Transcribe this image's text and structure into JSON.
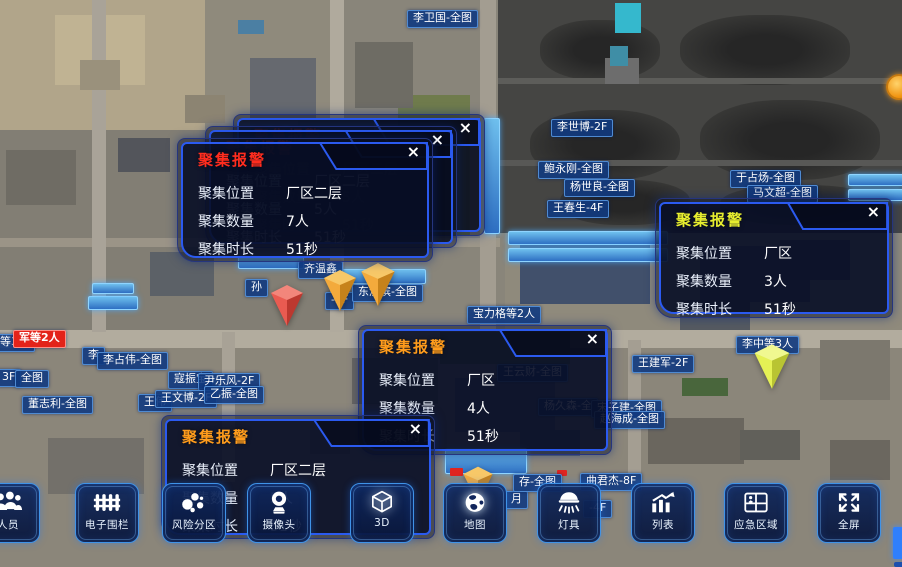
{
  "ui": {
    "close_glyph": "×"
  },
  "alarm_panels": [
    {
      "variant": "ghost",
      "x": 233,
      "y": 114,
      "w": 250,
      "h": 120,
      "title": "聚集报警",
      "title_color": "#8a1812",
      "fields": [
        {
          "label": "聚集位置",
          "value": "厂区二层"
        },
        {
          "label": "聚集数量",
          "value": "5人"
        },
        {
          "label": "聚集时长",
          "value": "51秒"
        }
      ]
    },
    {
      "variant": "ghost",
      "x": 205,
      "y": 126,
      "w": 250,
      "h": 120,
      "title": "聚集报警",
      "title_color": "#8a1812",
      "fields": [
        {
          "label": "聚集位置",
          "value": "厂区二层"
        },
        {
          "label": "聚集数量",
          "value": "5人"
        },
        {
          "label": "聚集时长",
          "value": "51秒"
        }
      ]
    },
    {
      "variant": "front",
      "x": 177,
      "y": 138,
      "w": 254,
      "h": 122,
      "title": "聚集报警",
      "title_color": "#ff2d1f",
      "fields": [
        {
          "label": "聚集位置",
          "value": "厂区二层"
        },
        {
          "label": "聚集数量",
          "value": "7人"
        },
        {
          "label": "聚集时长",
          "value": "51秒"
        }
      ]
    },
    {
      "variant": "front",
      "x": 655,
      "y": 198,
      "w": 236,
      "h": 118,
      "title": "聚集报警",
      "title_color": "#e7ee2f",
      "fields": [
        {
          "label": "聚集位置",
          "value": "厂区"
        },
        {
          "label": "聚集数量",
          "value": "3人"
        },
        {
          "label": "聚集时长",
          "value": "51秒"
        }
      ]
    },
    {
      "variant": "front",
      "x": 358,
      "y": 325,
      "w": 252,
      "h": 128,
      "title": "聚集报警",
      "title_color": "#ff9c1c",
      "fields": [
        {
          "label": "聚集位置",
          "value": "厂区"
        },
        {
          "label": "聚集数量",
          "value": "4人"
        },
        {
          "label": "聚集时长",
          "value": "51秒"
        }
      ]
    },
    {
      "variant": "front",
      "x": 161,
      "y": 415,
      "w": 272,
      "h": 122,
      "title": "聚集报警",
      "title_color": "#ff9c1c",
      "fields": [
        {
          "label": "聚集位置",
          "value": "厂区二层"
        },
        {
          "label": "聚集数量",
          "value": "5人"
        },
        {
          "label": "聚集时长",
          "value": "51秒"
        }
      ]
    }
  ],
  "map_labels": [
    {
      "text": "李卫国-全图",
      "x": 407,
      "y": 10
    },
    {
      "text": "李世博-2F",
      "x": 551,
      "y": 119
    },
    {
      "text": "鲍永刚-全图",
      "x": 538,
      "y": 161
    },
    {
      "text": "杨世良-全图",
      "x": 564,
      "y": 179
    },
    {
      "text": "王春生-4F",
      "x": 547,
      "y": 200
    },
    {
      "text": "于占炀-全图",
      "x": 730,
      "y": 170
    },
    {
      "text": "马文超-全图",
      "x": 747,
      "y": 185
    },
    {
      "text": "齐温鑫",
      "x": 298,
      "y": 261
    },
    {
      "text": "孙",
      "x": 245,
      "y": 279
    },
    {
      "text": "-5F",
      "x": 325,
      "y": 292
    },
    {
      "text": "东济滨-全图",
      "x": 352,
      "y": 284
    },
    {
      "text": "宝力格等2人",
      "x": 467,
      "y": 306
    },
    {
      "text": "王云财-全图",
      "x": 497,
      "y": 364
    },
    {
      "text": "杨久森-全",
      "x": 538,
      "y": 398
    },
    {
      "text": "宋子建-全图",
      "x": 591,
      "y": 400
    },
    {
      "text": "赵海成-全图",
      "x": 594,
      "y": 411
    },
    {
      "text": "王建军-2F",
      "x": 632,
      "y": 355
    },
    {
      "text": "李中等3人",
      "x": 736,
      "y": 336
    },
    {
      "text": "等3人",
      "x": -6,
      "y": 334
    },
    {
      "text": "军等2人",
      "x": 13,
      "y": 330,
      "variant": "red"
    },
    {
      "text": "李",
      "x": 82,
      "y": 347
    },
    {
      "text": "李占伟-全图",
      "x": 97,
      "y": 352
    },
    {
      "text": "3F",
      "x": -4,
      "y": 369
    },
    {
      "text": "全图",
      "x": 15,
      "y": 370
    },
    {
      "text": "寇振宝",
      "x": 168,
      "y": 371
    },
    {
      "text": "尹乐风-2F",
      "x": 198,
      "y": 373
    },
    {
      "text": "王伟",
      "x": 138,
      "y": 394
    },
    {
      "text": "王文博-2F",
      "x": 155,
      "y": 390
    },
    {
      "text": "乙振-全图",
      "x": 204,
      "y": 386
    },
    {
      "text": "董志利-全图",
      "x": 22,
      "y": 396
    },
    {
      "text": "月",
      "x": 505,
      "y": 491
    },
    {
      "text": "存-全图",
      "x": 513,
      "y": 474
    },
    {
      "text": "曲君杰-8F",
      "x": 580,
      "y": 473
    },
    {
      "text": "-4F",
      "x": 583,
      "y": 500
    }
  ],
  "map_pins": [
    {
      "color": "red",
      "x": 266,
      "y": 281,
      "w": 42,
      "h": 46
    },
    {
      "color": "orange",
      "x": 320,
      "y": 266,
      "w": 40,
      "h": 46
    },
    {
      "color": "orange",
      "x": 356,
      "y": 259,
      "w": 44,
      "h": 48
    },
    {
      "color": "yellow",
      "x": 750,
      "y": 340,
      "w": 44,
      "h": 50
    },
    {
      "color": "orange",
      "x": 456,
      "y": 463,
      "w": 44,
      "h": 42
    }
  ],
  "pin_colors": {
    "red": {
      "body": "#e6453a",
      "top": "#f2867b"
    },
    "orange": {
      "body": "#f29f22",
      "top": "#f7c868"
    },
    "yellow": {
      "body": "#e2ef3e",
      "top": "#f0f890"
    }
  },
  "toolbar": {
    "items": [
      {
        "label": "人员",
        "icon": "people-icon",
        "x": -24
      },
      {
        "label": "电子围栏",
        "icon": "fence-icon",
        "x": 75
      },
      {
        "label": "风险分区",
        "icon": "bubbles-icon",
        "x": 162
      },
      {
        "label": "摄像头",
        "icon": "camera-icon",
        "x": 247
      },
      {
        "label": "3D",
        "icon": "cube-icon",
        "x": 350,
        "glow": true
      },
      {
        "label": "地图",
        "icon": "globe-icon",
        "x": 443,
        "glow": true
      },
      {
        "label": "灯具",
        "icon": "lamp-icon",
        "x": 537
      },
      {
        "label": "列表",
        "icon": "chart-icon",
        "x": 631
      },
      {
        "label": "应急区域",
        "icon": "emergency-icon",
        "x": 724
      },
      {
        "label": "全屏",
        "icon": "fullscreen-icon",
        "x": 817
      }
    ]
  },
  "edge_widgets": {
    "orange_dot": {
      "x": 886,
      "y": 74
    },
    "blue_tab": {
      "x": 893,
      "y": 527,
      "w": 9,
      "h": 32
    },
    "blue_tab2": {
      "x": 894,
      "y": 562,
      "w": 8,
      "h": 5
    }
  }
}
